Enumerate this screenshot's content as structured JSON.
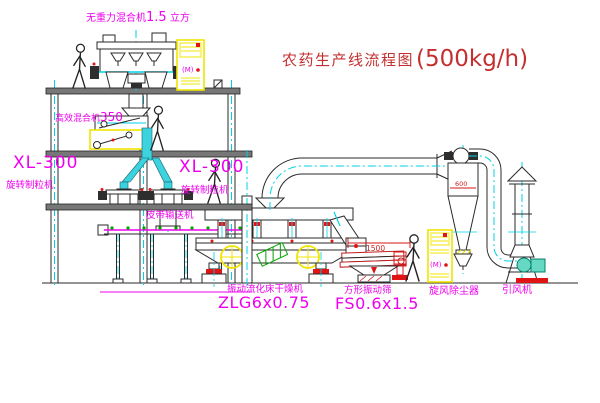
{
  "title": {
    "main": "农药生产线流程图",
    "capacity": "(500kg/h)"
  },
  "labels": {
    "top_mixer": {
      "name": "无重力混合机",
      "size": "1.5",
      "unit": "立方"
    },
    "mid_mixer": {
      "name": "高效混合机",
      "size": "350"
    },
    "granulator_left": {
      "model": "XL-300",
      "name": "旋转制粒机"
    },
    "granulator_right": {
      "model": "XL-300",
      "name": "旋转制粒机"
    },
    "belt_conveyor": "皮带输送机",
    "fluid_bed_dryer": {
      "name": "振动流化床干燥机",
      "model": "ZLG6x0.75"
    },
    "vibrating_screen": {
      "name": "方形振动筛",
      "model": "FS0.6x1.5"
    },
    "cyclone": "旋风除尘器",
    "induced_draft_fan": "引风机"
  },
  "dimensions": {
    "screen_length": "1500",
    "cyclone_diameter": "600"
  },
  "cabinet_mark": "(M)",
  "colors": {
    "background": "#ffffff",
    "line_black": "#2a2a2a",
    "centerline_cyan": "#00d2e6",
    "chute_cyan_fill": "#3cd2de",
    "cabinet_yellow": "#f0e400",
    "label_magenta": "#ee00ee",
    "title_red": "#c43030",
    "detail_red": "#e01414",
    "conveyor_green_dot": "#00a300",
    "fan_teal": "#00806c"
  }
}
